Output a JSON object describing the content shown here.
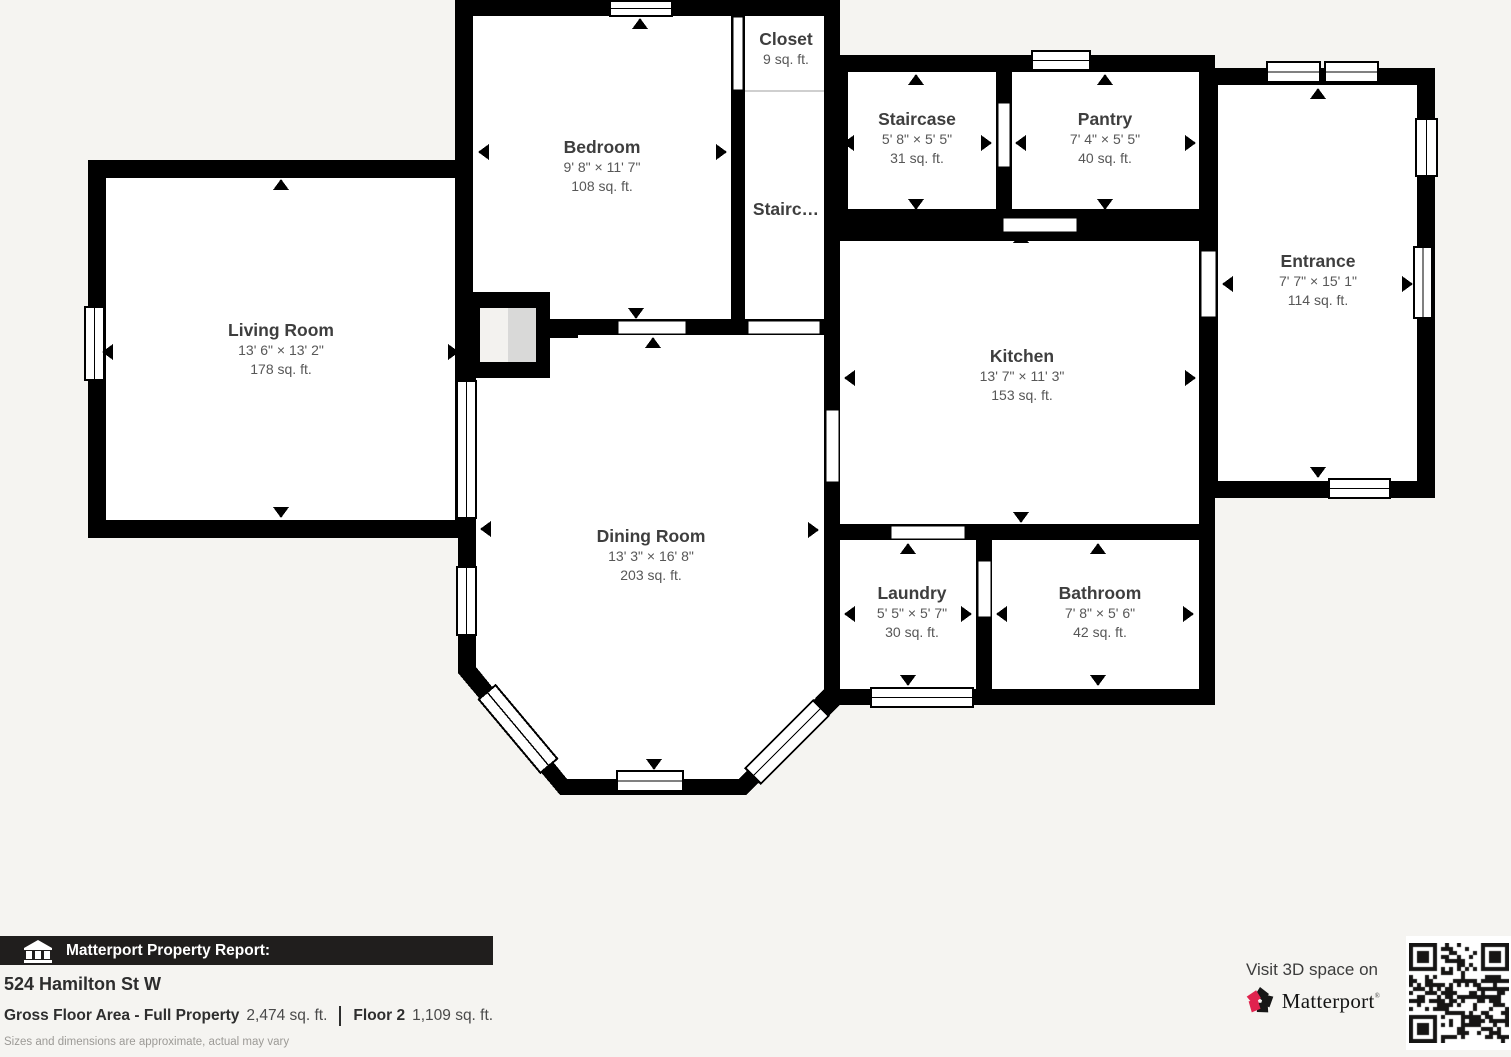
{
  "plan": {
    "rooms": [
      {
        "name": "Living Room",
        "dims": "13' 6\" × 13' 2\"",
        "area": "178 sq. ft."
      },
      {
        "name": "Bedroom",
        "dims": "9' 8\" × 11' 7\"",
        "area": "108 sq. ft."
      },
      {
        "name": "Closet",
        "dims": "",
        "area": "9 sq. ft."
      },
      {
        "name": "Stairc…",
        "dims": "",
        "area": ""
      },
      {
        "name": "Staircase",
        "dims": "5' 8\" × 5' 5\"",
        "area": "31 sq. ft."
      },
      {
        "name": "Pantry",
        "dims": "7' 4\" × 5' 5\"",
        "area": "40 sq. ft."
      },
      {
        "name": "Entrance",
        "dims": "7' 7\" × 15' 1\"",
        "area": "114 sq. ft."
      },
      {
        "name": "Kitchen",
        "dims": "13' 7\" × 11' 3\"",
        "area": "153 sq. ft."
      },
      {
        "name": "Dining Room",
        "dims": "13' 3\" × 16' 8\"",
        "area": "203 sq. ft."
      },
      {
        "name": "Laundry",
        "dims": "5' 5\" × 5' 7\"",
        "area": "30 sq. ft."
      },
      {
        "name": "Bathroom",
        "dims": "7' 8\" × 5' 6\"",
        "area": "42 sq. ft."
      }
    ]
  },
  "footer": {
    "bar_title": "Matterport Property Report:",
    "address": "524 Hamilton St W",
    "gross_area_label": "Gross Floor Area - Full Property",
    "gross_area_value": "2,474 sq. ft.",
    "floor_label": "Floor 2",
    "floor_value": "1,109 sq. ft.",
    "disclaimer": "Sizes and dimensions are approximate, actual may vary"
  },
  "cta": {
    "text": "Visit 3D space on",
    "brand": "Matterport",
    "mark": "®"
  },
  "colors": {
    "wall": "#000000",
    "room_fill": "#ffffff",
    "background": "#f5f4f1",
    "bar_background": "#201e1d",
    "brand_pink": "#e0234e"
  },
  "icons": [
    "house-icon",
    "matterport-pinwheel-icon",
    "qr-code",
    "door-direction-arrow-icon",
    "window-marker",
    "fireplace-structure"
  ]
}
